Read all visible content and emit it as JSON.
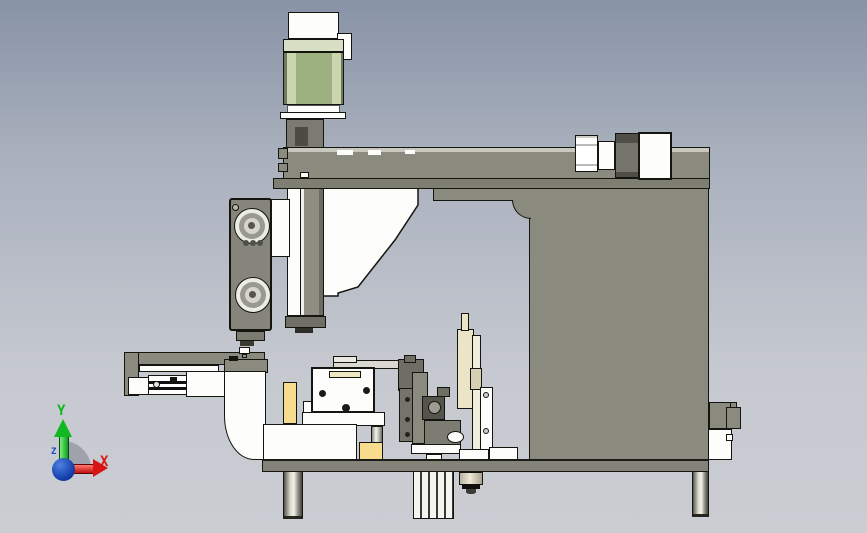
{
  "triad": {
    "x_label": "X",
    "y_label": "Y",
    "z_label": "Z"
  },
  "palette": {
    "bg_top": "#8893a6",
    "bg_mid": "#aab1be",
    "bg_low": "#c6c9d0",
    "bg_bottom": "#cbcdd3",
    "outline": "#15150f",
    "body_gray": "#8a8a7e",
    "body_mid": "#7e7e73",
    "body_dark": "#55554c",
    "edge_light": "#c8c8be",
    "white": "#fdfdfb",
    "off_white": "#ecece6",
    "motor_green": "#9db080",
    "motor_green_light": "#ccd6ae",
    "motor_collar": "#d8dfc4",
    "cream": "#ece4c6",
    "cream_light": "#f2eedd",
    "yellow": "#f6dc8c",
    "axis_x": "#d81414",
    "axis_y": "#12b81f",
    "axis_z": "#2244cc",
    "arc_gray": "rgba(125,130,142,0.55)"
  }
}
